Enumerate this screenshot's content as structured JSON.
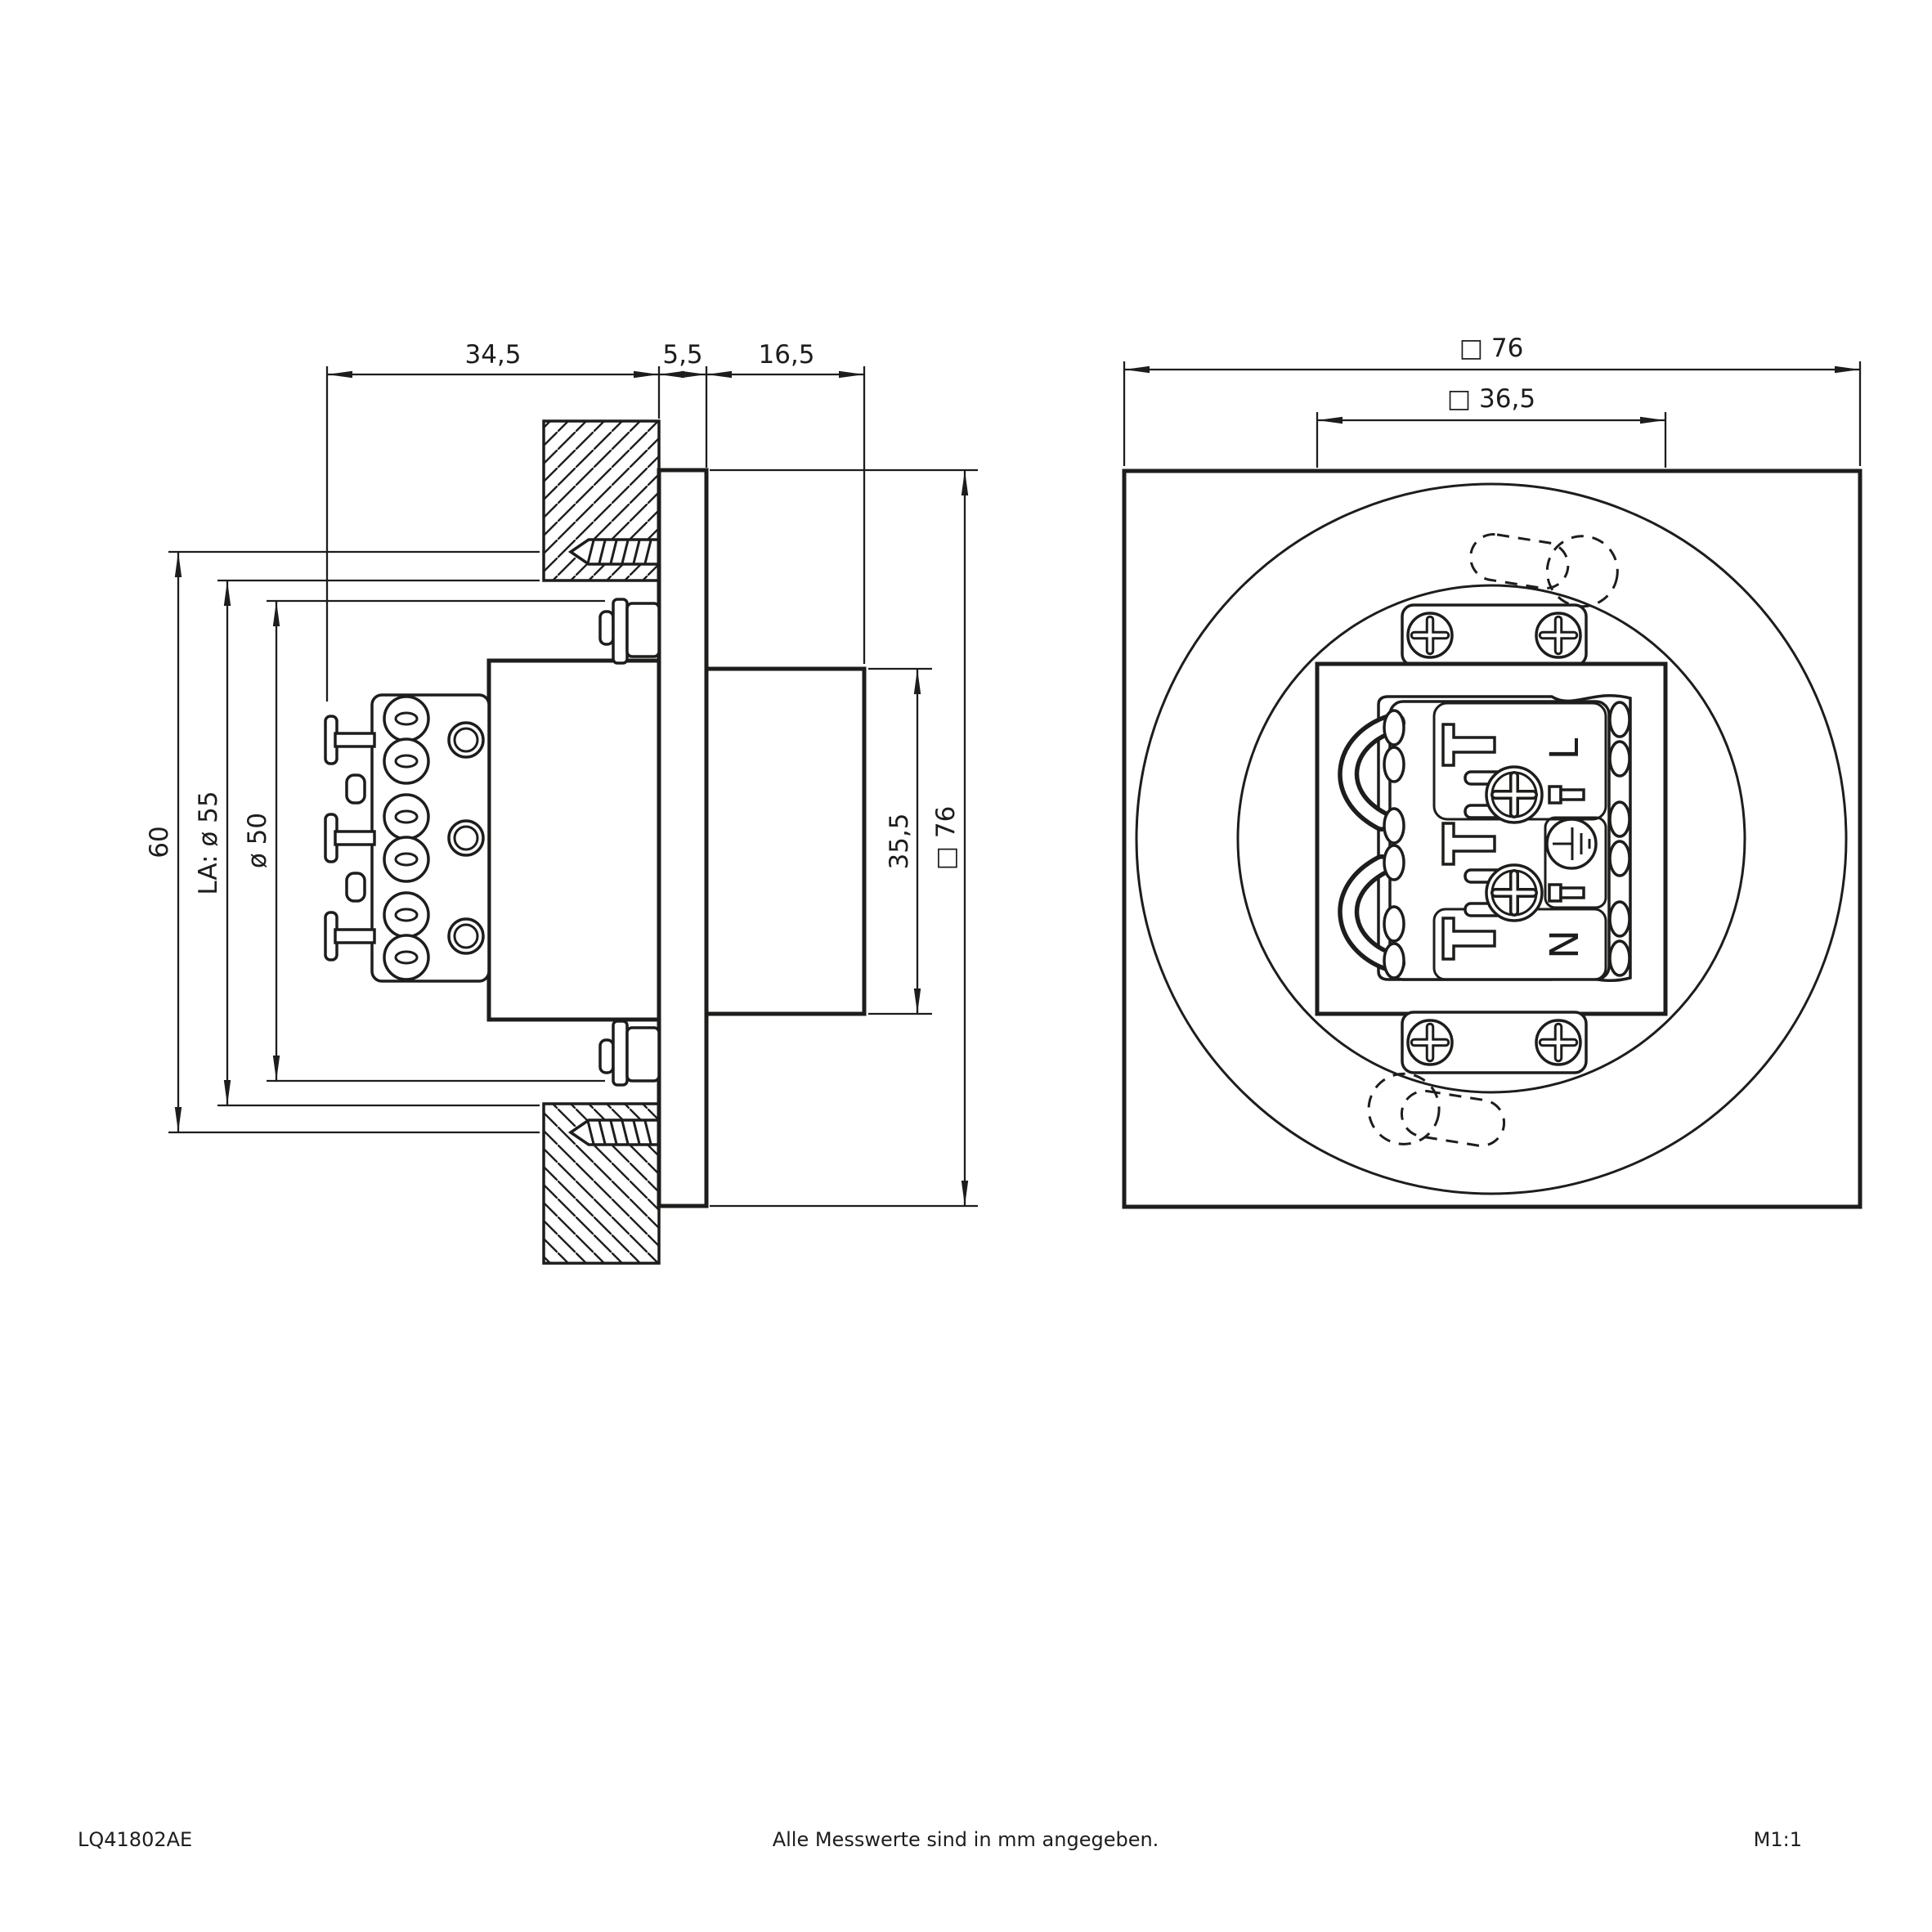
{
  "drawing": {
    "ink": "#1d1d1b",
    "side_view": {
      "dims": {
        "depth_behind_wall": "34,5",
        "bezel_thickness": "5,5",
        "protrusion_depth": "16,5",
        "fixing_span": "60",
        "cutout_diameter": "LA: ø 55",
        "body_diameter": "ø 50",
        "front_body_height": "35,5",
        "bezel_size": "□ 76"
      }
    },
    "front_view": {
      "dims": {
        "bezel_size": "□ 76",
        "gear_box_size": "□ 36,5"
      },
      "terminals": {
        "live": "L",
        "neutral": "N"
      }
    },
    "footer": {
      "article_number": "LQ41802AE",
      "note": "Alle Messwerte sind in mm angegeben.",
      "scale": "M1:1"
    }
  }
}
